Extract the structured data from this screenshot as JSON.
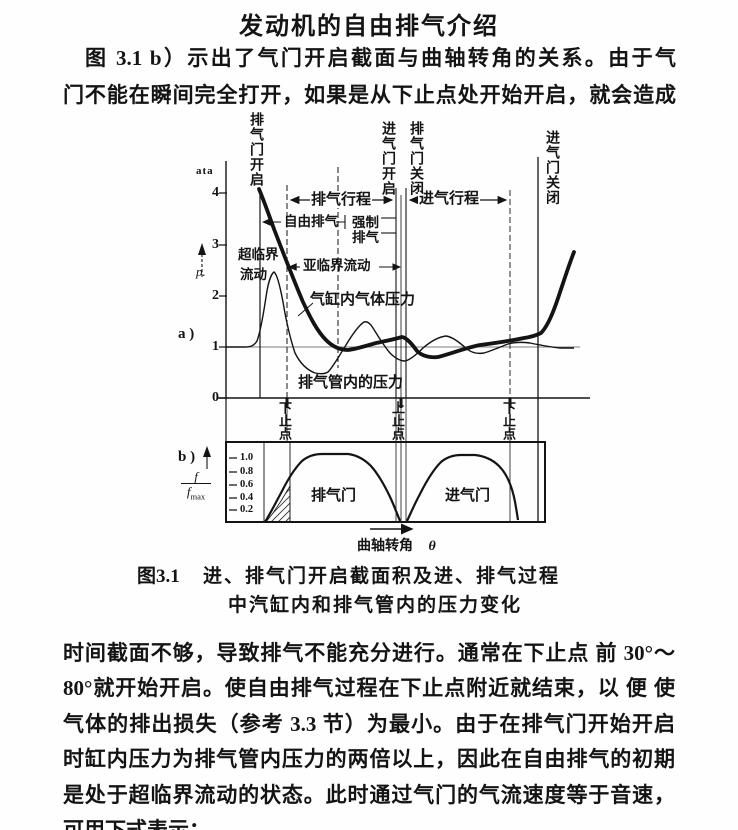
{
  "page": {
    "title": "发动机的自由排气介绍",
    "para1": [
      "图 3.1 b）示出了气门开启截面与曲轴转角的关系。由于气",
      "门不能在瞬间完全打开，如果是从下止点处开始开启，就会造成"
    ],
    "para2": [
      "时间截面不够，导致排气不能充分进行。通常在下止点 前 30°～",
      "80°就开始开启。使自由排气过程在下止点附近就结束，以 便 使",
      "气体的排出损失（参考 3.3 节）为最小。由于在排气门开始开启",
      "时缸内压力为排气管内压力的两倍以上，因此在自由排气的初期",
      "是处于超临界流动的状态。此时通过气门的气流速度等于音速，",
      "可用下式表示："
    ]
  },
  "figure": {
    "panel_a": "a )",
    "panel_b": "b )",
    "y_unit": "ata",
    "p_symbol": "p.",
    "a_ticks": [
      "4",
      "3",
      "2",
      "1",
      "0"
    ],
    "b_ticks": [
      "1.0",
      "0.8",
      "0.6",
      "0.4",
      "0.2"
    ],
    "frac_num": "f",
    "frac_den": "f",
    "frac_sub": "max",
    "events": {
      "exhaust_open": "排气门开启",
      "intake_open": "进气门开启",
      "exhaust_close": "排气门关闭",
      "intake_close": "进气门关闭"
    },
    "strokes": {
      "exhaust": "排气行程",
      "intake": "进气行程"
    },
    "ann": {
      "free": "自由排气",
      "forced1": "强制",
      "forced2": "排气",
      "super1": "超临界",
      "super2": "流动",
      "sub": "亚临界流动",
      "cyl": "气缸内气体压力",
      "pipe": "排气管内的压力"
    },
    "dead_centers": [
      "下止点",
      "上止点",
      "下止点"
    ],
    "valves": {
      "exhaust": "排气门",
      "intake": "进气门"
    },
    "x_label": "曲轴转角",
    "x_sym": "θ",
    "caption_no": "图3.1",
    "caption1": "进、排气门开启截面积及进、排气过程",
    "caption2": "中汽缸内和排气管内的压力变化"
  },
  "chart_data": [
    {
      "type": "line",
      "panel": "a",
      "title": "进、排气过程中汽缸内和排气管内的压力变化",
      "xlabel": "曲轴转角 θ",
      "ylabel": "p (ata)",
      "ylim": [
        0,
        4.3
      ],
      "yticks": [
        0,
        1,
        2,
        3,
        4
      ],
      "grid": false,
      "reference_line_y": 1,
      "x_events": [
        "排气门开启",
        "下止点",
        "进气门开启",
        "上止点",
        "排气门关闭",
        "下止点",
        "进气门关闭"
      ],
      "series": [
        {
          "name": "气缸内气体压力",
          "style": "thick",
          "x_frac": [
            0.25,
            0.28,
            0.31,
            0.34,
            0.38,
            0.42,
            0.46,
            0.5,
            0.55,
            0.59,
            0.63,
            0.69,
            0.75,
            0.81,
            0.87,
            0.91,
            0.95,
            0.98
          ],
          "values": [
            3.9,
            3.3,
            2.6,
            1.9,
            1.3,
            1.05,
            0.93,
            1.0,
            1.05,
            1.12,
            0.85,
            0.66,
            0.82,
            0.92,
            1.0,
            1.08,
            1.5,
            2.6
          ]
        },
        {
          "name": "排气管内的压力",
          "style": "thin",
          "x_frac": [
            0.18,
            0.26,
            0.29,
            0.32,
            0.36,
            0.4,
            0.44,
            0.49,
            0.53,
            0.57,
            0.61,
            0.66,
            0.72,
            0.77,
            0.82,
            0.88,
            0.93,
            0.98
          ],
          "values": [
            1.0,
            1.05,
            2.2,
            1.4,
            0.55,
            0.48,
            0.9,
            1.47,
            1.1,
            0.85,
            1.0,
            1.15,
            1.19,
            0.9,
            0.95,
            1.1,
            1.05,
            1.0
          ]
        }
      ],
      "annotations": [
        "超临界流动",
        "亚临界流动",
        "自由排气",
        "强制排气",
        "排气行程",
        "进气行程"
      ]
    },
    {
      "type": "area",
      "panel": "b",
      "xlabel": "曲轴转角 θ",
      "ylabel": "f/fmax",
      "ylim": [
        0,
        1.1
      ],
      "yticks": [
        0.2,
        0.4,
        0.6,
        0.8,
        1.0
      ],
      "series": [
        {
          "name": "排气门",
          "shape": "bell",
          "span": "排气门开启 → 排气门关闭",
          "peak": 1.0
        },
        {
          "name": "进气门",
          "shape": "bell",
          "span": "进气门开启 → 进气门关闭",
          "peak": 1.0
        }
      ],
      "hatched_region": "排气门开启初期（自由排气阶段）"
    }
  ]
}
